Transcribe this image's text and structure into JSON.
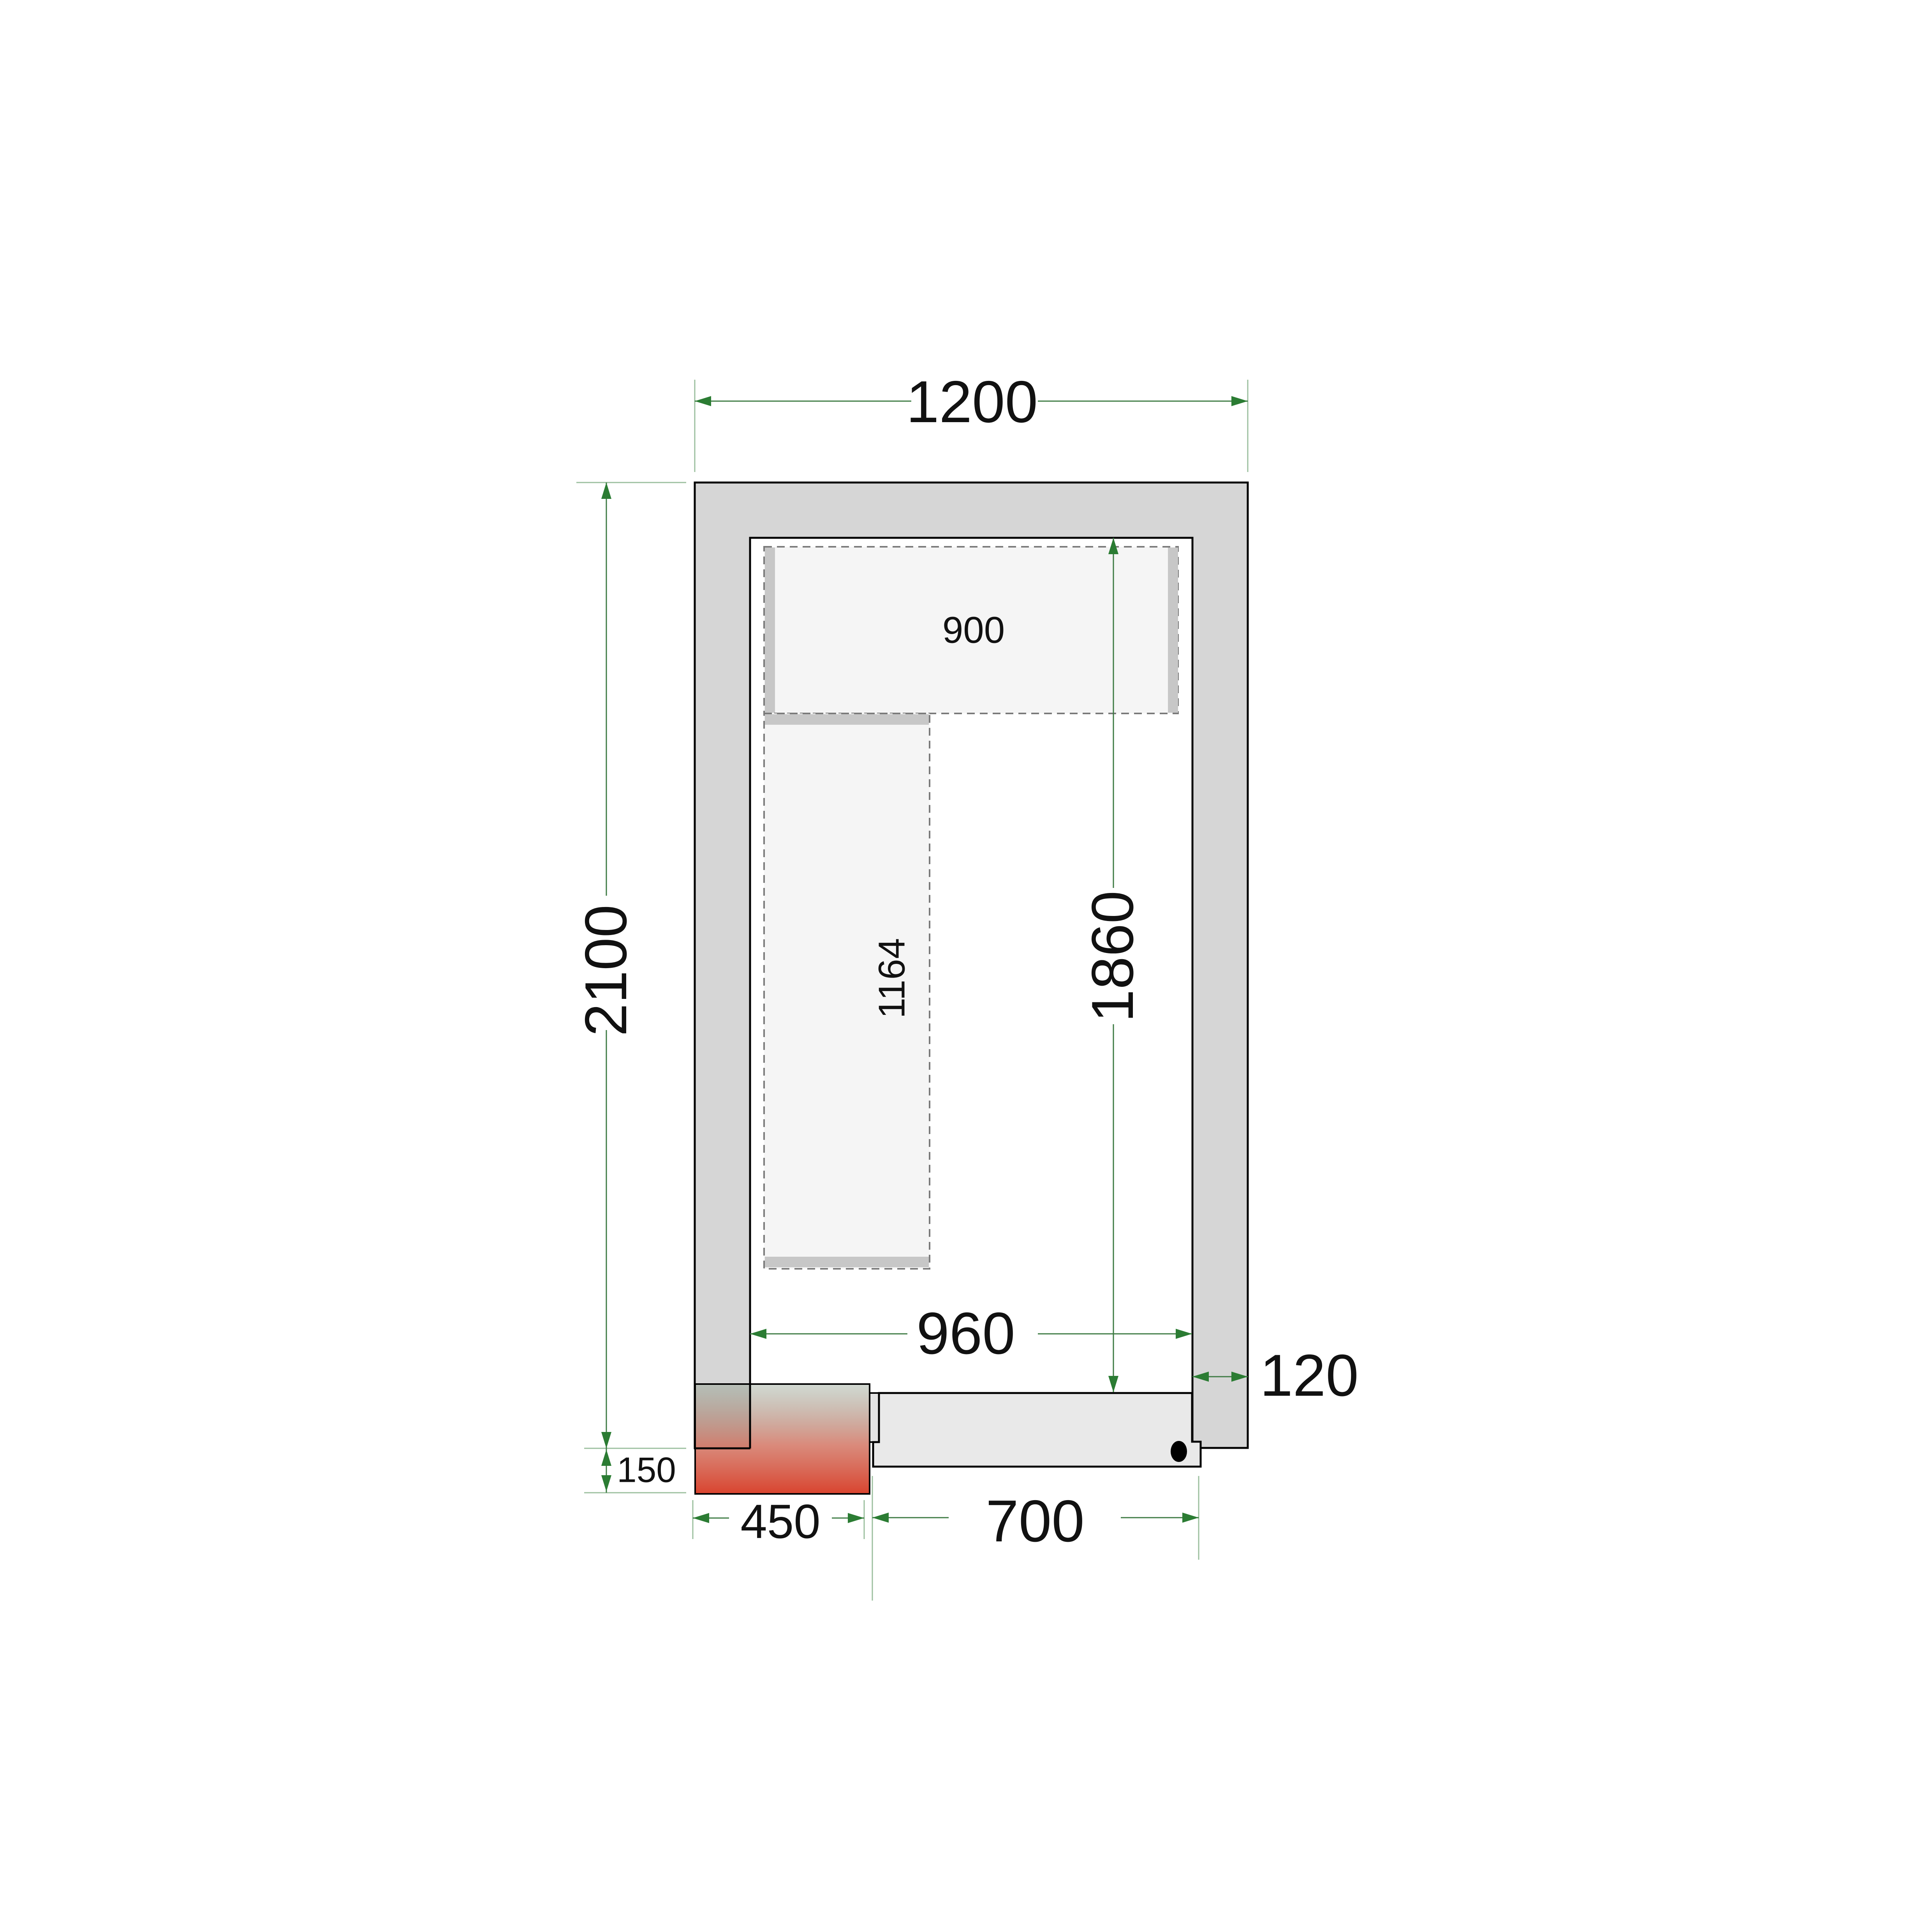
{
  "drawing": {
    "type": "cold-room-floor-plan",
    "dimensions_mm": {
      "outer_width": "1200",
      "outer_depth": "2100",
      "inner_width": "960",
      "inner_depth": "1860",
      "wall_thickness": "120",
      "door_width": "700",
      "cooling_unit_width": "450",
      "cooling_unit_protrusion": "150",
      "top_shelf_length": "900",
      "left_shelf_length": "1164"
    },
    "colors": {
      "background": "#ffffff",
      "wall_fill": "#d6d6d6",
      "door_fill": "#e9e9e9",
      "jamb_fill": "#e3e3e3",
      "shelf_fill": "#f5f5f5",
      "shelf_support_fill": "#c7c7c7",
      "outline": "#000000",
      "dimension_line": "#3c7a42",
      "extension_line": "#9bbf9e",
      "arrow": "#2b7c33",
      "label_color": "#111111",
      "unit_gradient_top": "rgba(125,145,125,0.35)",
      "unit_gradient_mid": "rgba(205,100,80,0.75)",
      "unit_gradient_bottom": "rgba(216,60,38,0.96)",
      "handle_color": "#000000"
    }
  }
}
